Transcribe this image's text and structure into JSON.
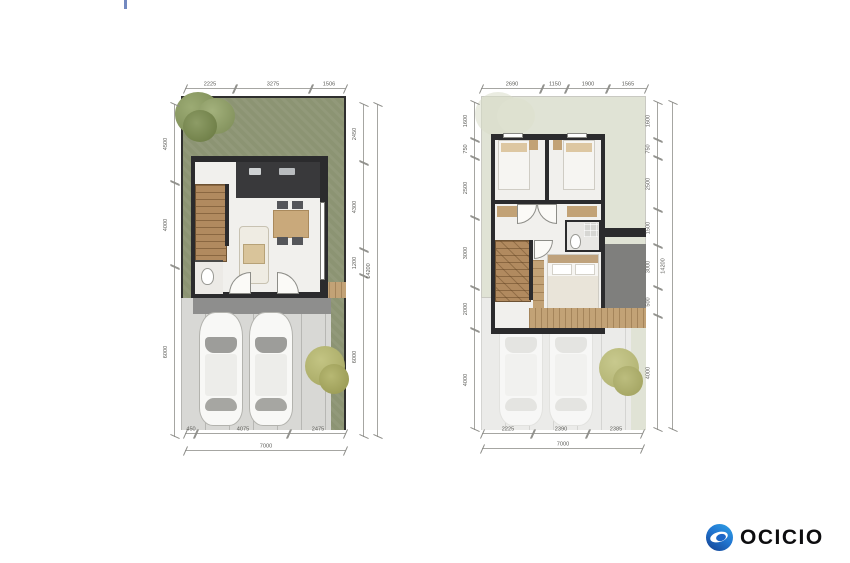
{
  "palette": {
    "grass": "#8c9473",
    "ghostgrass": "#e0e3d5",
    "wall": "#2b2b2d",
    "floor": "#f1f0ed",
    "wood": "#b18a5f",
    "deck": "#c2a276",
    "carport": "#d8d8d5",
    "ghostcarport": "#ebebe9",
    "porch": "#8e8e8d",
    "roofgray": "#7f7f7d",
    "bush": "#b7b873",
    "dimtext": "#5c5c58"
  },
  "top_mark": {
    "color": "#5b74b5"
  },
  "logo": {
    "text": "OCICIO",
    "circle_light": "#2fa3e6",
    "circle_dark": "#133f8f",
    "swoosh": "#ffffff",
    "text_color": "#0d0d0f"
  },
  "plans": {
    "ground": {
      "name": "ground-floor",
      "dims": {
        "top": [
          "2225",
          "3275",
          "1506"
        ],
        "left": [
          "4500",
          "4000",
          "6000"
        ],
        "right": [
          "2450",
          "4300",
          "1200",
          "6000"
        ],
        "right_total": "14200",
        "bottom": [
          "450",
          "4075",
          "2475"
        ],
        "bottom_total": "7000"
      }
    },
    "upper": {
      "name": "upper-floor",
      "dims": {
        "top": [
          "2690",
          "1150",
          "1900",
          "1565"
        ],
        "left": [
          "1600",
          "750",
          "2500",
          "3000",
          "2000",
          "4000"
        ],
        "right": [
          "1600",
          "750",
          "2500",
          "1500",
          "3000",
          "500",
          "4000"
        ],
        "right_total": "14200",
        "bottom": [
          "2225",
          "2390",
          "2385"
        ],
        "bottom_total": "7000"
      }
    }
  }
}
